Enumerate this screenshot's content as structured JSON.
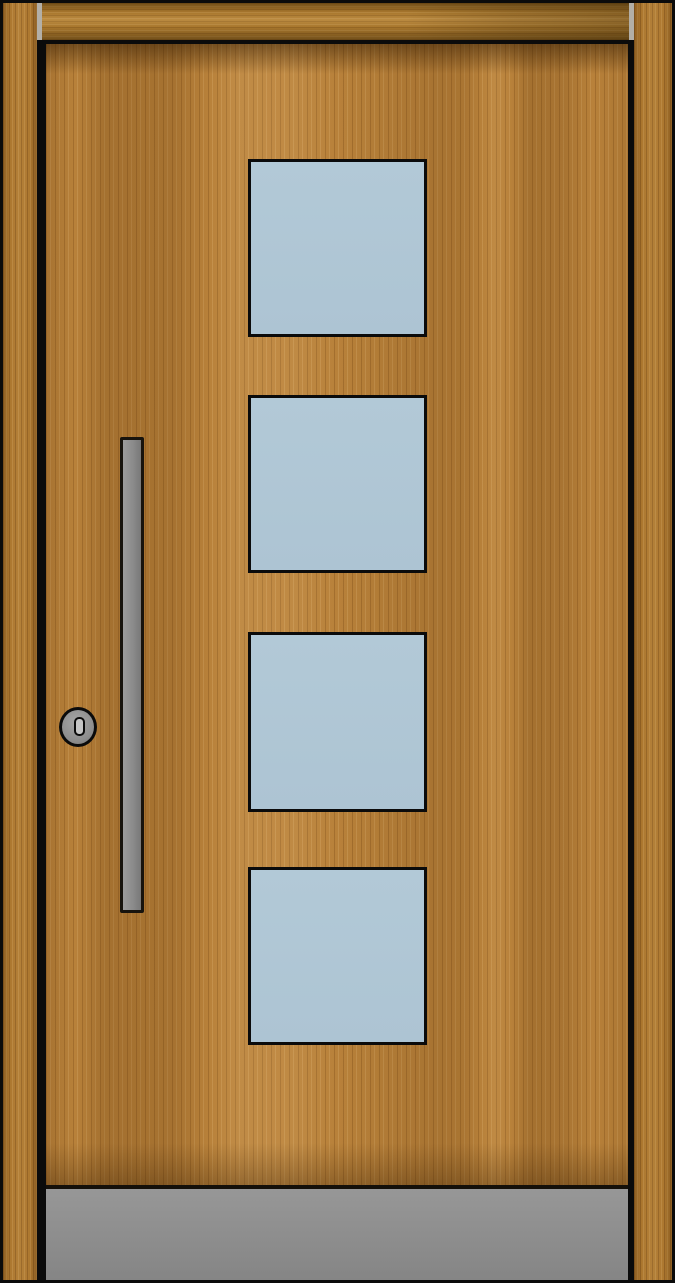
{
  "scene": {
    "description": "Product render of a modern timber entrance door: wood-grain leaf inside a timber frame with a horizontal head beam, four square light-blue glazing panes stacked vertically right of centre, a long vertical grey pull handle on the left, a round cylinder lock with keyhole, and a grey kick plate across the bottom of the leaf",
    "visible_text": ""
  },
  "door": {
    "glazing": {
      "pane_count": 4,
      "pane_shape": "square",
      "arrangement": "single vertical column, right of centre"
    },
    "hardware": {
      "handle": "vertical bar pull handle, left side",
      "lock": "round cylinder lock with vertical keyhole slot",
      "kick_plate": "full-width grey plate at bottom of leaf"
    },
    "frame": {
      "parts": "left jamb, right jamb, head beam with light grey end caps"
    }
  },
  "colors": {
    "outline": "#0b0b0b",
    "wood_base": "#b8813a",
    "frame_wood": "#ad7830",
    "lintel_wood": "#a9782e",
    "frame_cap": "#b3afa7",
    "glass": "#b2c9d7",
    "glass_low": "#adc4d3",
    "kick_light": "#979797",
    "kick_dark": "#858585",
    "handle_light": "#9c9c9c",
    "handle_dark": "#787878",
    "lock_body": "#a6a6a6",
    "keyhole_center": "#c6c6c6"
  }
}
